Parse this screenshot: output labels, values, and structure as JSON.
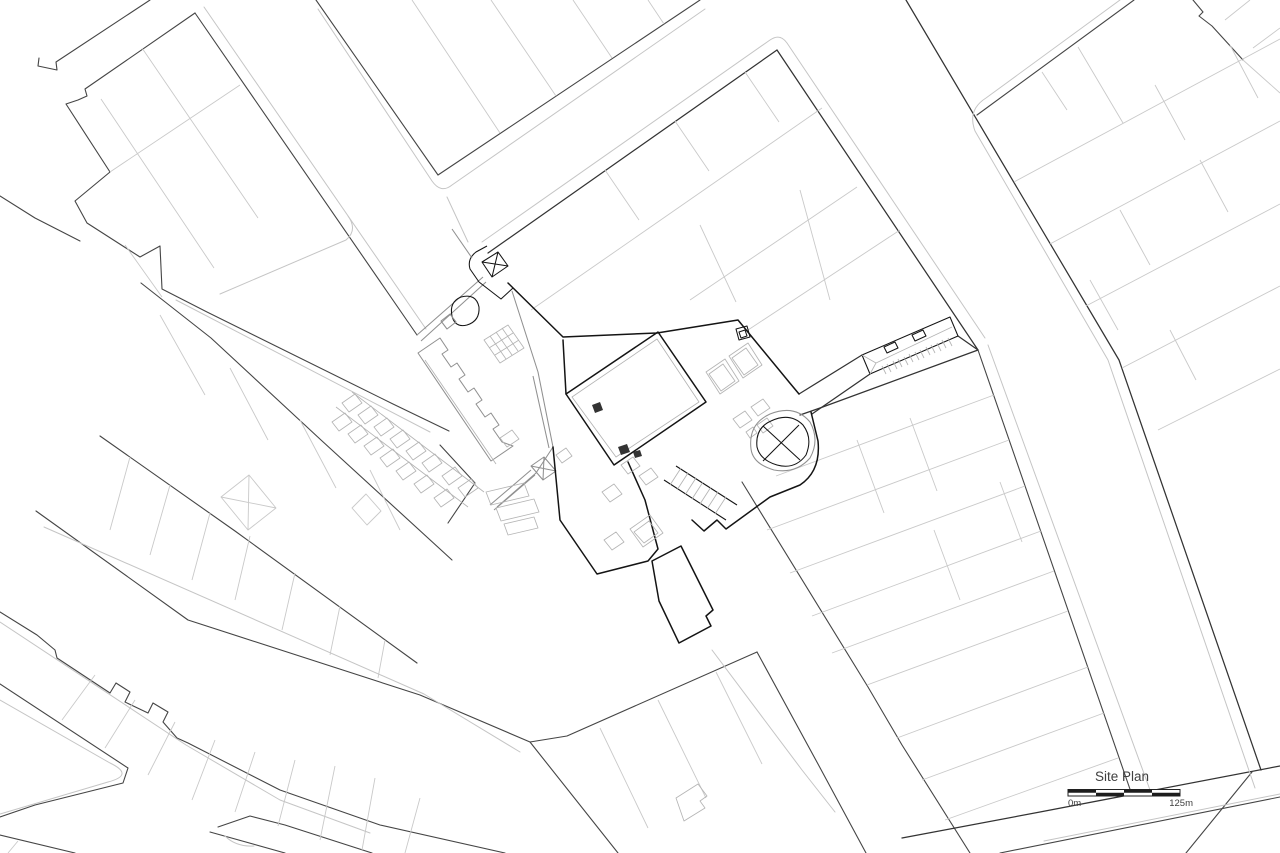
{
  "annotation": {
    "title": "Site Plan",
    "scale_start_label": "0m",
    "scale_end_label": "125m",
    "scale_segments": 4
  },
  "palette": {
    "background": "#ffffff",
    "block_edge": "#454545",
    "street_edge_dark": "#333333",
    "lot_line": "#c9c9c9",
    "curb_line": "#c5c5c5",
    "building_ink": "#141414",
    "site_mid_gray": "#909090",
    "site_light_gray": "#b4b4b4",
    "annotation_ink": "#3f3f3f"
  }
}
